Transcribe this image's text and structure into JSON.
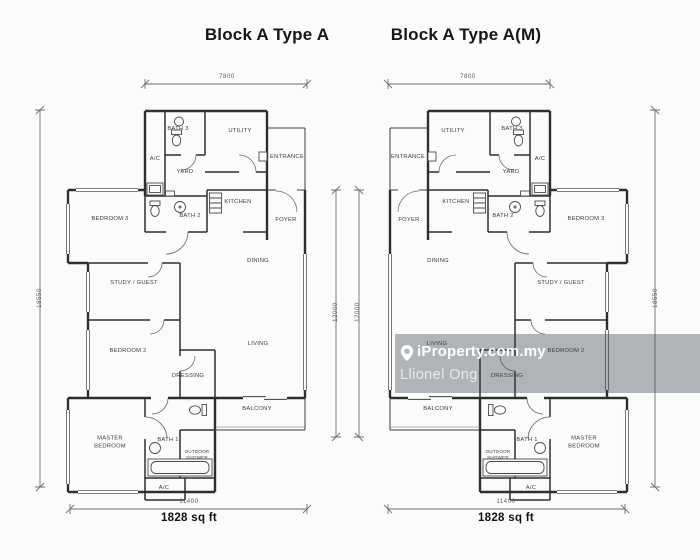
{
  "image": {
    "width": 700,
    "height": 560,
    "background": "#fbfbfb",
    "line_color": "#2e2e2e",
    "dim_line_color": "#6e6e6e"
  },
  "watermark": {
    "brand": "iProperty.com.my",
    "agent": "Llionel Ong",
    "pin_icon": "map-pin-icon",
    "band_color": "rgba(56,64,73,0.38)",
    "text_color": "#ffffff"
  },
  "plans": [
    {
      "title": "Block A Type A",
      "area": "1828 sq ft",
      "dimensions": {
        "top": "7800",
        "side": "18550",
        "inner": "12000",
        "bottom": "11400"
      },
      "rooms": [
        {
          "label": "BATH 3",
          "x": 178,
          "y": 130
        },
        {
          "label": "UTILITY",
          "x": 240,
          "y": 132
        },
        {
          "label": "A/C",
          "x": 155,
          "y": 160
        },
        {
          "label": "YARD",
          "x": 185,
          "y": 173
        },
        {
          "label": "ENTRANCE",
          "x": 287,
          "y": 158
        },
        {
          "label": "BEDROOM 3",
          "x": 110,
          "y": 220
        },
        {
          "label": "BATH 2",
          "x": 190,
          "y": 217
        },
        {
          "label": "KITCHEN",
          "x": 238,
          "y": 203
        },
        {
          "label": "FOYER",
          "x": 286,
          "y": 221
        },
        {
          "label": "DINING",
          "x": 258,
          "y": 262
        },
        {
          "label": "STUDY / GUEST",
          "x": 134,
          "y": 284
        },
        {
          "label": "BEDROOM 2",
          "x": 128,
          "y": 352
        },
        {
          "label": "LIVING",
          "x": 258,
          "y": 345
        },
        {
          "label": "DRESSING",
          "x": 188,
          "y": 377
        },
        {
          "label": "BALCONY",
          "x": 257,
          "y": 410
        },
        {
          "label": "MASTER BEDROOM",
          "x": 110,
          "y": 443,
          "w": 48
        },
        {
          "label": "BATH 1",
          "x": 168,
          "y": 441
        },
        {
          "label": "OUTDOOR SHOWER",
          "x": 197,
          "y": 455,
          "w": 28,
          "s": 4.5
        },
        {
          "label": "A/C",
          "x": 164,
          "y": 489
        }
      ]
    },
    {
      "title": "Block A Type A(M)",
      "area": "1828 sq ft",
      "dimensions": {
        "top": "7800",
        "side": "18550",
        "inner": "12000",
        "bottom": "11400"
      },
      "rooms": [
        {
          "label": "BATH 3",
          "x": 512,
          "y": 130
        },
        {
          "label": "UTILITY",
          "x": 453,
          "y": 132
        },
        {
          "label": "A/C",
          "x": 540,
          "y": 160
        },
        {
          "label": "YARD",
          "x": 511,
          "y": 173
        },
        {
          "label": "ENTRANCE",
          "x": 408,
          "y": 158
        },
        {
          "label": "BEDROOM 3",
          "x": 586,
          "y": 220
        },
        {
          "label": "BATH 2",
          "x": 503,
          "y": 217
        },
        {
          "label": "KITCHEN",
          "x": 456,
          "y": 203
        },
        {
          "label": "FOYER",
          "x": 409,
          "y": 221
        },
        {
          "label": "DINING",
          "x": 438,
          "y": 262
        },
        {
          "label": "STUDY / GUEST",
          "x": 561,
          "y": 284
        },
        {
          "label": "BEDROOM 2",
          "x": 566,
          "y": 352
        },
        {
          "label": "LIVING",
          "x": 437,
          "y": 345
        },
        {
          "label": "DRESSING",
          "x": 507,
          "y": 377
        },
        {
          "label": "BALCONY",
          "x": 438,
          "y": 410
        },
        {
          "label": "MASTER BEDROOM",
          "x": 584,
          "y": 443,
          "w": 48
        },
        {
          "label": "BATH 1",
          "x": 527,
          "y": 441
        },
        {
          "label": "OUTDOOR SHOWER",
          "x": 498,
          "y": 455,
          "w": 28,
          "s": 4.5
        },
        {
          "label": "A/C",
          "x": 531,
          "y": 489
        }
      ]
    }
  ]
}
